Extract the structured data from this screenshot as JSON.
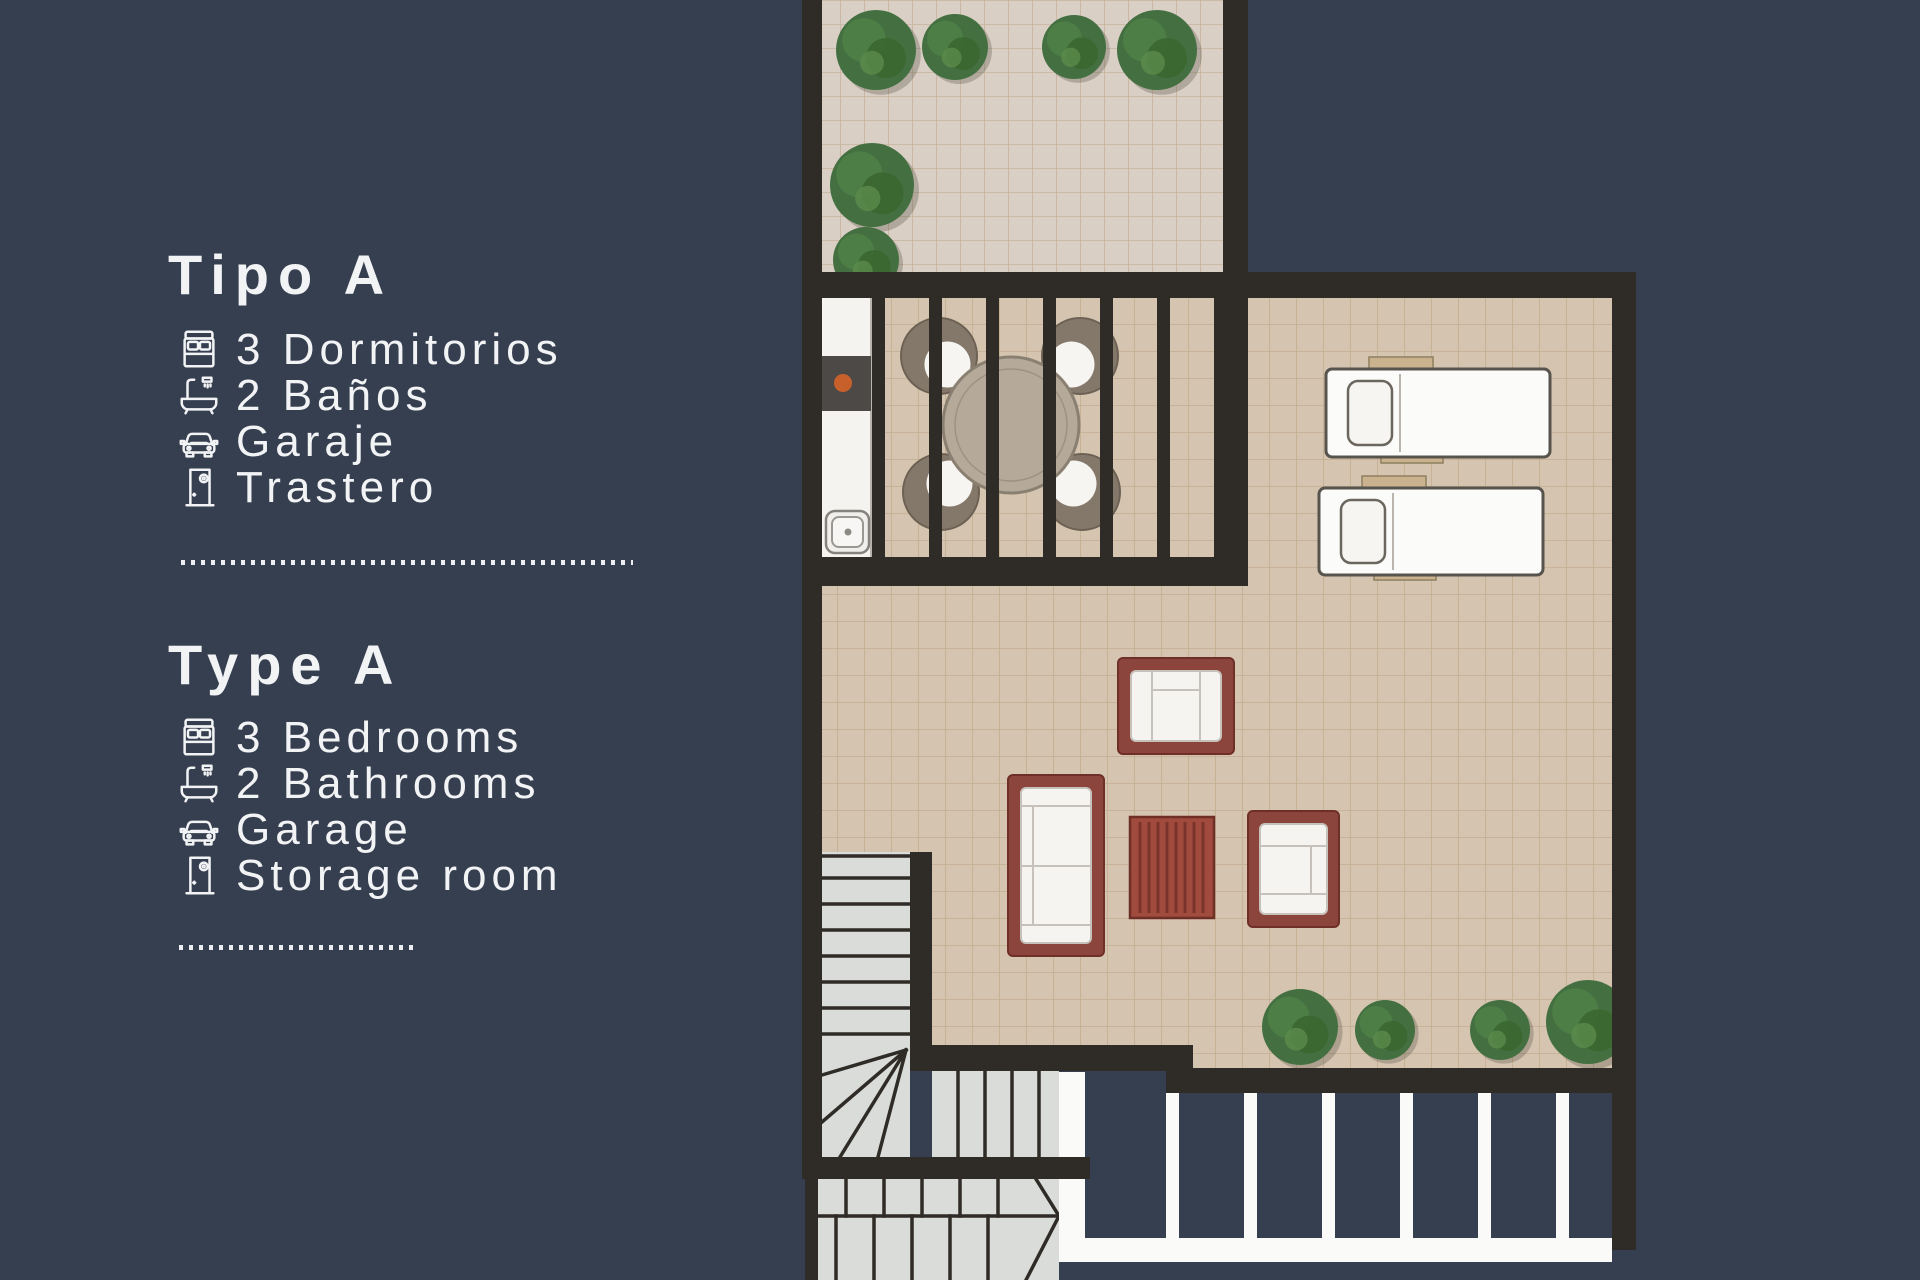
{
  "info_panel": {
    "sections": [
      {
        "id": "es",
        "title": "Tipo A",
        "features": [
          {
            "icon": "bed-icon",
            "label": "3 Dormitorios"
          },
          {
            "icon": "bathtub-icon",
            "label": "2 Baños"
          },
          {
            "icon": "car-icon",
            "label": "Garaje"
          },
          {
            "icon": "door-icon",
            "label": "Trastero"
          }
        ]
      },
      {
        "id": "en",
        "title": "Type A",
        "features": [
          {
            "icon": "bed-icon",
            "label": "3 Bedrooms"
          },
          {
            "icon": "bathtub-icon",
            "label": "2 Bathrooms"
          },
          {
            "icon": "car-icon",
            "label": "Garage"
          },
          {
            "icon": "door-icon",
            "label": "Storage room"
          }
        ]
      }
    ]
  },
  "colors": {
    "background": "#363F50",
    "text": "#F2F3F5",
    "wall": "#2F2B26",
    "tile_upper_terrace": "#D9CFC5",
    "tile_main_terrace": "#D5C4B0",
    "tile_grid_line": "#B2966F",
    "kitchen_counter": "#F4F3F0",
    "stove_block": "#4C4946",
    "burner_dot": "#C8602C",
    "stair_tread": "#DADCD9",
    "garage_marking": "#FAFAF8",
    "lounger_white": "#FBFBFA",
    "lounger_wood": "#C9B28D",
    "dining_table": "#B5A99A",
    "wicker_chair": "#84786A",
    "cushion_white": "#F6F5F2",
    "sofa_frame_red": "#8C453C",
    "coffee_table_red": "#A04B3D",
    "tree_green": "#447041"
  }
}
